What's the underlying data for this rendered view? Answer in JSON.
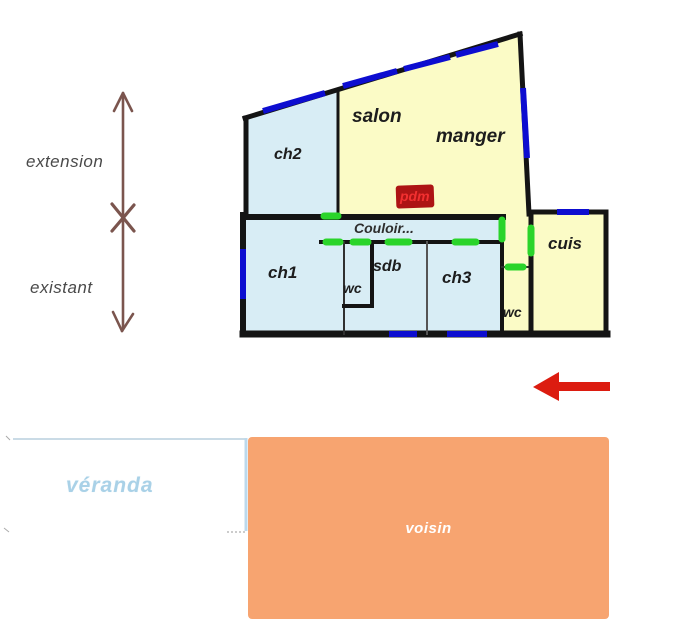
{
  "annotations": {
    "extension": "extension",
    "existant": "existant"
  },
  "plan": {
    "labels": {
      "ch2": "ch2",
      "salon": "salon",
      "manger": "manger",
      "pdm": "pdm",
      "couloir": "Couloir...",
      "ch1": "ch1",
      "wc_left": "wc",
      "sdb": "sdb",
      "ch3": "ch3",
      "wc_right": "wc",
      "cuis": "cuis"
    }
  },
  "exterior": {
    "veranda": "véranda",
    "voisin": "voisin"
  },
  "colors": {
    "room_blue": "#d8edf5",
    "room_yellow": "#fbfbc6",
    "wall_black": "#141414",
    "window_blue": "#0d0dd0",
    "door_green": "#2ad42a",
    "pdm_bg": "#ad1414",
    "pdm_text": "#f23030",
    "red_arrow": "#dc1c10",
    "axis_brown": "#7b554e",
    "voisin_orange": "#f7a470",
    "veranda_blue": "#a5cfe6",
    "annotation_gray": "#4a4a4a"
  }
}
